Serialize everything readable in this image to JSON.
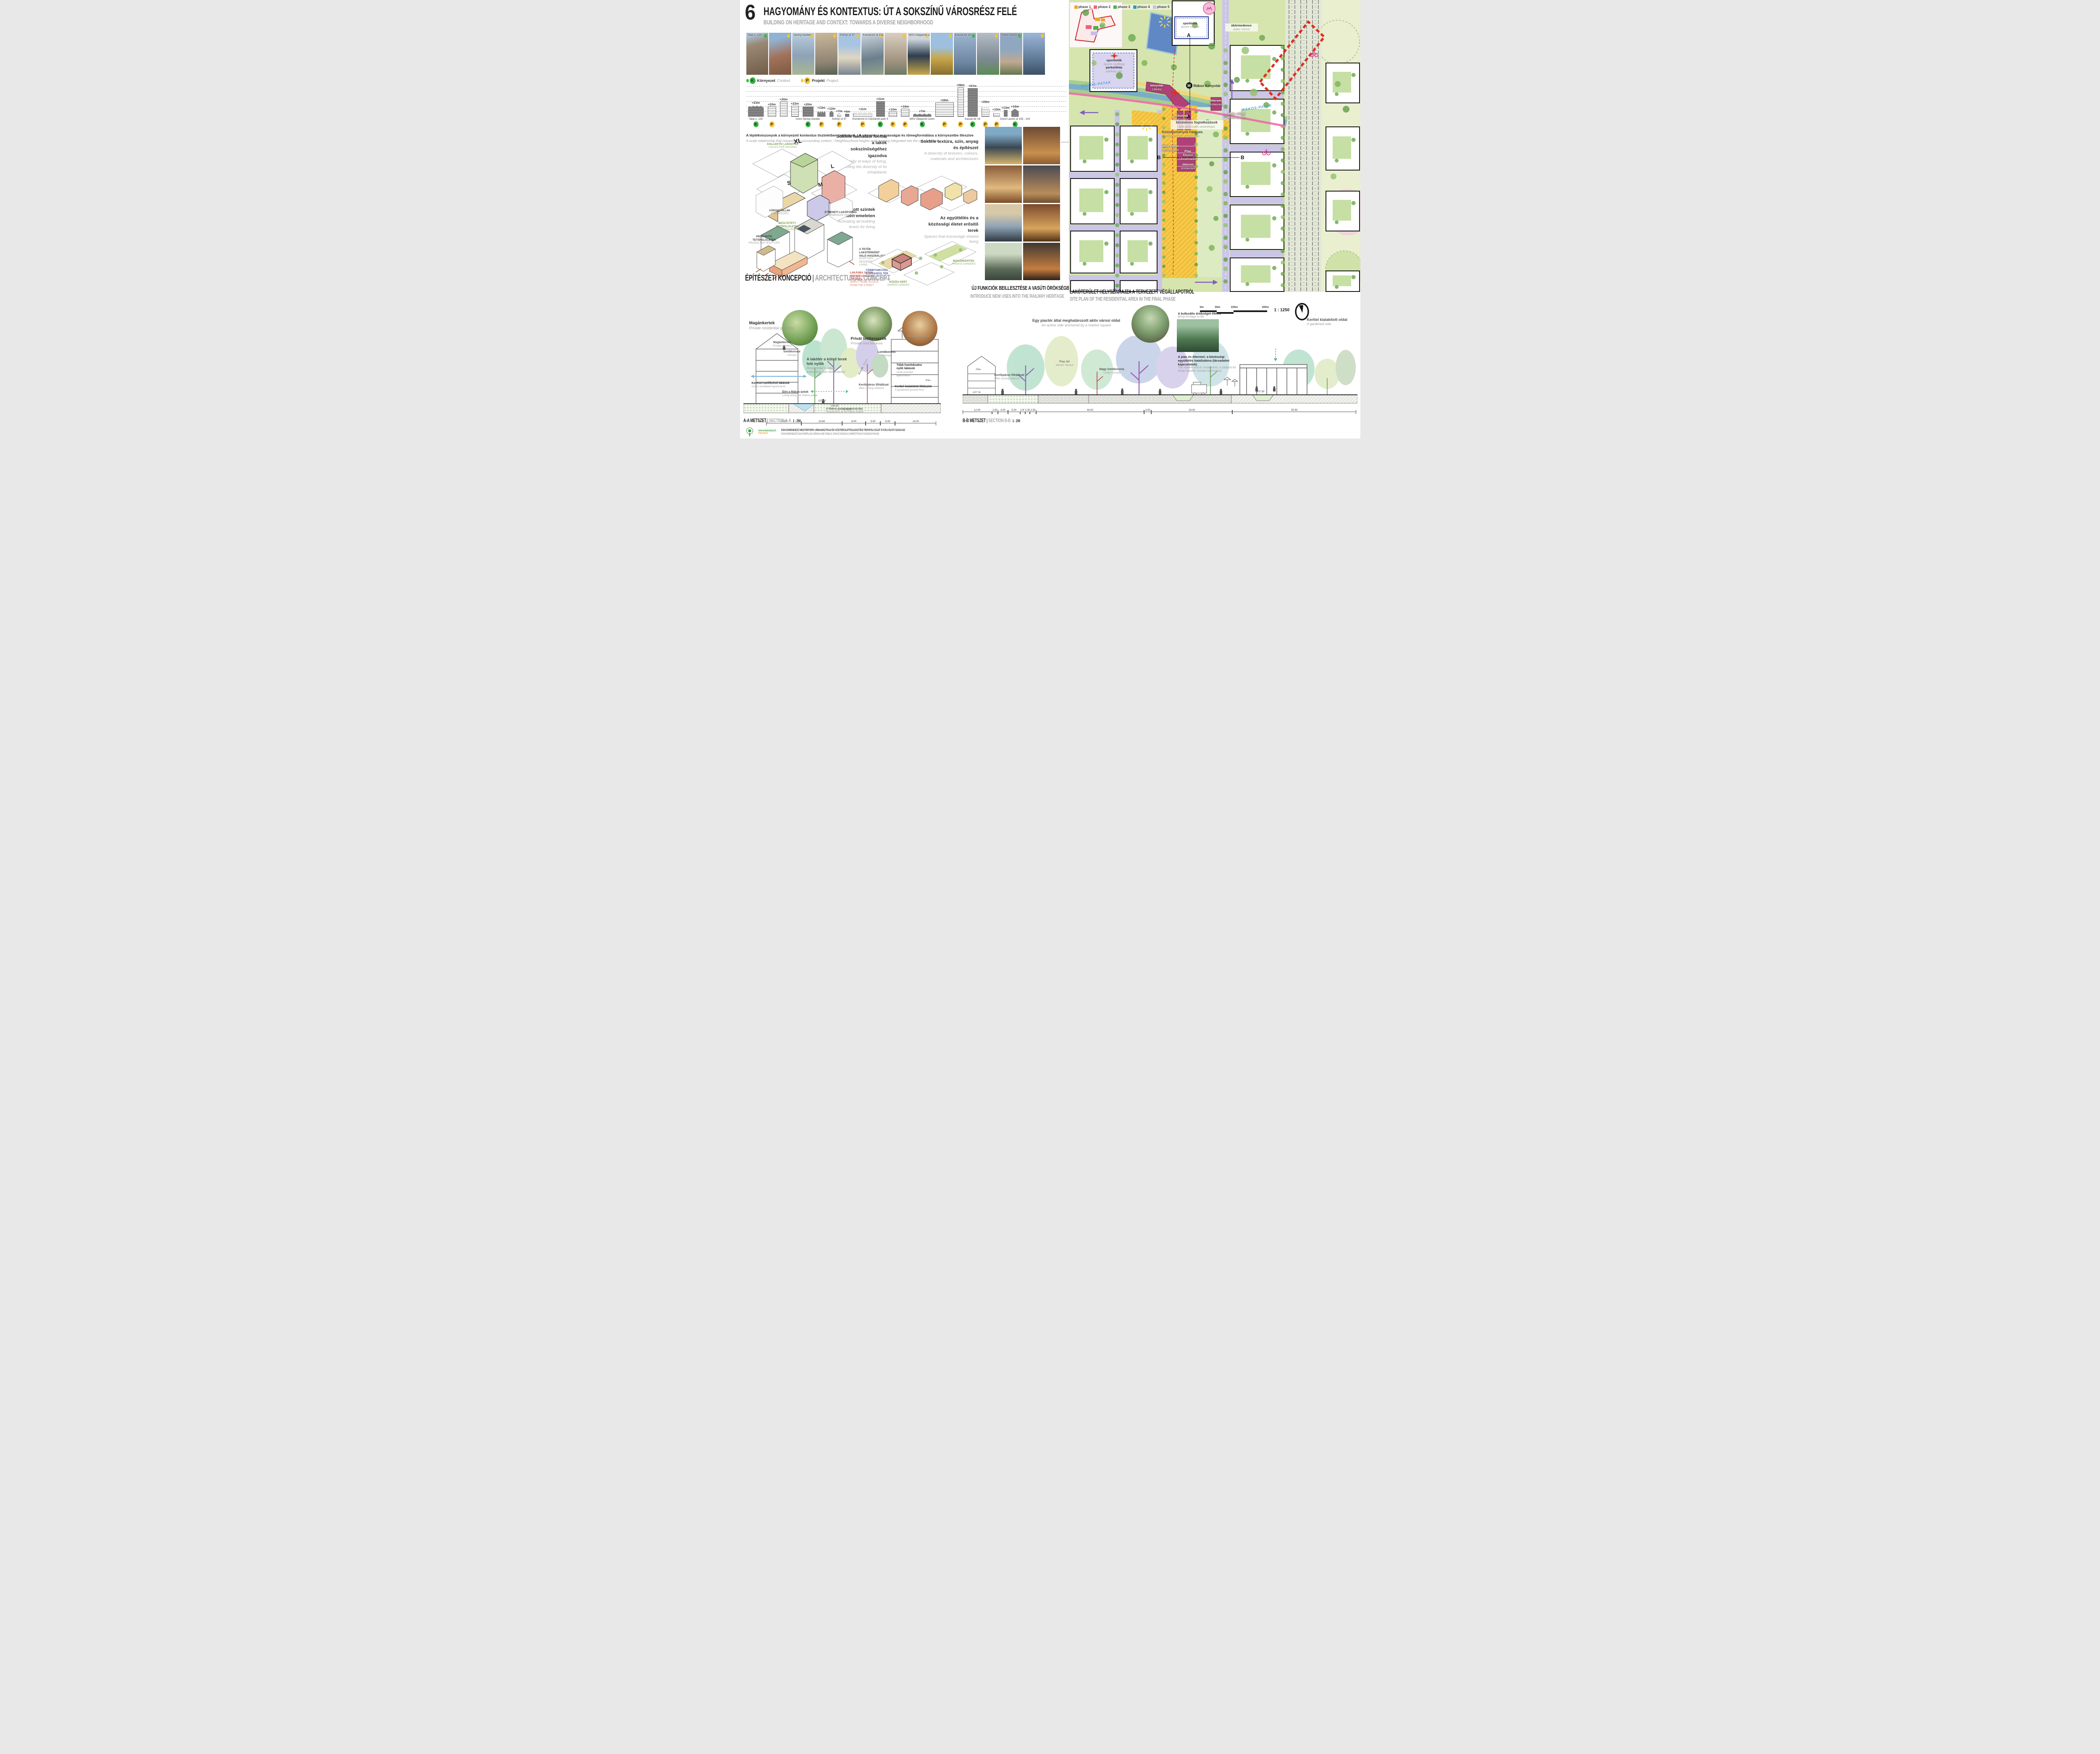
{
  "header": {
    "number": "6",
    "title": "HAGYOMÁNY ÉS KONTEXTUS: ÚT A SOKSZÍNŰ VÁROSRÉSZ FELÉ",
    "subtitle": "BUILDING ON HERITAGE AND CONTEXT: TOWARDS A DIVERSE NEIGHBORHOOD"
  },
  "legend": {
    "context_letter": "K",
    "context_hu": "Környezet",
    "context_en": "Context",
    "project_letter": "P",
    "project_hu": "Projekt",
    "project_en": "Project",
    "green": "#3db54a",
    "yellow": "#f5c23c"
  },
  "photo_strip": {
    "tiles": [
      {
        "label": "Tatai u. 124",
        "dot": "#3db54a"
      },
      {
        "label": "",
        "dot": "#f5c23c"
      },
      {
        "label": "Spring Garden",
        "dot": "#f5c23c"
      },
      {
        "label": "",
        "dot": "#f5c23c"
      },
      {
        "label": "Szőnyi út 47",
        "dot": "#f5c23c"
      },
      {
        "label": "Komáromi út 10a",
        "dot": "#f5c23c"
      },
      {
        "label": "",
        "dot": "#f5c23c"
      },
      {
        "label": "MÁV Gépjavító üzem",
        "dot": "#f5c23c"
      },
      {
        "label": "",
        "dot": "#f5c23c"
      },
      {
        "label": "Kassai tér 18",
        "dot": "#3db54a"
      },
      {
        "label": "",
        "dot": "#f5c23c"
      },
      {
        "label": "Szent László út 156",
        "dot": "#3db54a"
      },
      {
        "label": "",
        "dot": "#f5c23c"
      }
    ]
  },
  "height_diagram": {
    "caption_hu": "A léptékviszonyok a környezeti kontextus tiszteletben tartásával. / A városrész magasságai és tömegformálása a környezetbe illesztve",
    "caption_en": "A scale relationship that respects the surrounding context. / Neighbourhood heights and massing integrated into the urban context",
    "buildings": [
      {
        "h": "+23m",
        "m": 23,
        "w": 38,
        "tone": "dark",
        "shape": "dome",
        "name": "Tatai u. 124",
        "badge": "K"
      },
      {
        "h": "+20m",
        "m": 20,
        "w": 20,
        "tone": "light",
        "shape": "flat",
        "badge": "P"
      },
      {
        "h": "+30m",
        "m": 30,
        "w": 18,
        "tone": "light",
        "shape": "flat"
      },
      {
        "h": "+22m",
        "m": 22,
        "w": 18,
        "tone": "light",
        "shape": "flat"
      },
      {
        "h": "+20m",
        "m": 20,
        "w": 26,
        "tone": "dark",
        "shape": "flat",
        "name": "Avico Spring Garden",
        "badge": "K"
      },
      {
        "h": "+13m",
        "m": 13,
        "w": 20,
        "tone": "dark",
        "shape": "saw",
        "badge": "P"
      },
      {
        "h": "+12m",
        "m": 12,
        "w": 10,
        "tone": "dark",
        "shape": "gable"
      },
      {
        "h": "+7m",
        "m": 7,
        "w": 9,
        "tone": "light",
        "shape": "gable",
        "name": "Szőnyi út 47",
        "badge": "P"
      },
      {
        "h": "+6m",
        "m": 6,
        "w": 10,
        "tone": "dark",
        "shape": "flat"
      },
      {
        "h": "+11m",
        "m": 11,
        "w": 46,
        "tone": "light",
        "shape": "saw",
        "name": "Komáromi út 10a",
        "badge": "P"
      },
      {
        "h": "+31m",
        "m": 31,
        "w": 21,
        "tone": "dark",
        "shape": "flat",
        "name": "Sárrét park 4",
        "badge": "K"
      },
      {
        "h": "+10m",
        "m": 10,
        "w": 20,
        "tone": "light",
        "shape": "flat",
        "badge": "P"
      },
      {
        "h": "+16m",
        "m": 16,
        "w": 20,
        "tone": "light",
        "shape": "flat",
        "badge": "P"
      },
      {
        "h": "+7m",
        "m": 7,
        "w": 44,
        "tone": "dark",
        "shape": "saw",
        "name": "MÁV Gépjavító üzem",
        "badge": "K"
      },
      {
        "h": "+28m",
        "m": 28,
        "w": 44,
        "tone": "light",
        "shape": "flat",
        "badge": "P"
      },
      {
        "h": "+58m",
        "m": 58,
        "w": 15,
        "tone": "light",
        "shape": "flat",
        "badge": "P"
      },
      {
        "h": "+57m",
        "m": 57,
        "w": 24,
        "tone": "dark",
        "shape": "flat",
        "name": "Kassai tér 18",
        "badge": "K"
      },
      {
        "h": "+25m",
        "m": 25,
        "w": 19,
        "tone": "light",
        "shape": "saw",
        "badge": "P"
      },
      {
        "h": "+10m",
        "m": 10,
        "w": 16,
        "tone": "light",
        "shape": "saw",
        "badge": "P"
      },
      {
        "h": "+13m",
        "m": 13,
        "w": 9,
        "tone": "dark",
        "shape": "flat"
      },
      {
        "h": "+16m",
        "m": 16,
        "w": 18,
        "tone": "dark",
        "shape": "gable",
        "name": "Szent László út 156 - 143",
        "badge": "K"
      }
    ]
  },
  "concept": {
    "heading_hu": "ÉPÍTÉSZETI KONCEPCIÓ",
    "heading_en": "ARCHITECTURAL CONCEPT",
    "blocks": [
      {
        "hu": "Sokféle lakhatási forma, a lakók sokszínűségéhez igazodva",
        "en": "A diversity of ways of living, reflecting the diversity of its inhabitants"
      },
      {
        "hu": "Sokféle textúra, szín, anyag és építészet",
        "en": "A diversity of textures, colours, materials and architectures"
      },
      {
        "hu": "Lakott szintek minden emeleten",
        "en": "Activating all building levels for living"
      },
      {
        "hu": "Az együttélés és a közösségi életet erősítő terek",
        "en": "Spaces that encourage shared living"
      }
    ],
    "d1": {
      "collective_hu": "KOLLEKTÍV LAKHATÁS",
      "collective_en": "COLLECTIVE HOUSING",
      "xl": "XL",
      "l": "L",
      "s": "S",
      "m": "M",
      "villas_hu": "VÁROSI VILLÁK",
      "villas_en": "ROW HOUSES",
      "interm_hu": "ÁTMENETI LAKÓFORMA",
      "interm_en": "INTERMEDIATE HOUSING"
    },
    "d3": {
      "veg_hu": "BEÜLTETETT TETŐFELÜLETEK",
      "veg_en": "VEGETATED ROOFS",
      "prod_hu": "PRODUKTÍV TETŐFELÜLETEK",
      "prod_en": "PRODUCTIVE ROOFTOPS",
      "roofliv_hu": "A TETŐK LAKÓTÉRKÉNT VALÓ HASZNÁLATA",
      "roofliv_en": "ROOFTOPS DESIGNED FOR LIVING",
      "access_hu": "LAKÁSBA JUTÁS KÖZVETLENÜL AZ UTCÁRÓL",
      "access_en": "DIRECT HOME ACCESS FROM THE STREET"
    },
    "d4": {
      "multi_hu": "TÖBBFUNKCIÓS KÖZÖSSÉGI TÉR",
      "multi_en": "MULTIPURPOSE COMMUNITY ROOM",
      "shared_hu": "KÖZÖS KERT",
      "shared_en": "SHARED GARDEN",
      "private_hu": "MAGÁNKERTEK",
      "private_en": "PRIVATE GARDENS"
    }
  },
  "railway_heading": {
    "hu": "ÚJ FUNKCIÓK BEILLESZTÉSE A VASÚTI ÖRÖKSÉGBE",
    "en": "INTRODUCE NEW USES INTO THE RAILWAY HERITAGE"
  },
  "siteplan": {
    "heading_hu": "LAKÓTERÜLET HELYSZÍNRAJZA A TERVEZETT VÉGÁLLAPOTRÓL",
    "heading_en": "SITE PLAN OF THE RESIDENTIAL AREA IN THE FINAL PHASE",
    "phases": [
      {
        "label": "phase 1",
        "color": "#f0a32a"
      },
      {
        "label": "phase 2",
        "color": "#e8647c"
      },
      {
        "label": "phase 3",
        "color": "#4cb050"
      },
      {
        "label": "phase 4",
        "color": "#2f9bb5"
      },
      {
        "label": "phase 5",
        "color": "#c9bce6"
      }
    ],
    "scalebar": {
      "t0": "0m",
      "t50": "50m",
      "t100": "100m",
      "t200": "200m",
      "ratio": "1 : 1250"
    },
    "labels": {
      "box1_hu": "sporttetők",
      "box1_en": "Sports rooftop",
      "box2a_hu": "sporttetők",
      "box2a_en": "Sports rooftoop",
      "box2b_hu": "parkolóház",
      "box2b_en": "parking silo",
      "water_hu": "ükörmedence",
      "water_en": "water mirror",
      "river1": "RÁKOS-PATAK",
      "river2": "RÁKOS-PATAK",
      "plaza_top_hu": "aktív előtér",
      "plaza_top_en": "active plaza",
      "metro_m": "M",
      "library_point": "Rákos Könyvtár",
      "konyvtar_hu": "könyvtár",
      "konyvtar_en": "Library",
      "etterem1_hu": "étterem",
      "etterem1_en": "restaurant",
      "muhelyek_hu": "műhelyek",
      "muhelyek_en": "workshops",
      "kezmuves_hu": "kézműves foglalkozások",
      "kezmuves_en": "Arts and crafts workshops",
      "kozint_hu": "Közintézmények hálózata",
      "kozint_en": "A public facilities archipelago",
      "plaza_mid_hu": "aktív előtér",
      "plaza_mid_en": "active plaza",
      "piac_hu": "Piac",
      "piac_en1": "Market",
      "piac_en2": "/ foodmarket",
      "etterem2_hu": "étterem",
      "etterem2_en": "restaurant",
      "marker_a": "A",
      "marker_b": "B"
    }
  },
  "section_a": {
    "heading_hu": "A-A METSZET",
    "heading_en": "SECTION A-A",
    "scale": "1 : 250",
    "dims": [
      12.0,
      13.84,
      8.0,
      5.0,
      5.0,
      14.0
    ],
    "levels": [
      "107.00",
      "106.25",
      "105.50"
    ],
    "labels": {
      "magan_big_hu": "Magánkertek",
      "magan_big_en": "Private residential gardens",
      "magan_small_hu": "Magánkertek",
      "magan_small_en": "Private gardens",
      "lombkorona_hu": "lombkorona",
      "lombkorona_en": "canopy",
      "lakoter_hu": "A lakótér a külső terek felé nyílik",
      "lakoter_en": "Residential spaces extending into the exterior",
      "kereszt_hu": "Kereszt-szellőzésű lakások",
      "kereszt_en": "Cross-ventilated apartments",
      "elet_hu": "Élet a Rákos-patak",
      "elet_en": "Living along the Rákos-patak",
      "renat_hu": "A Rákos-patak renaturációja",
      "renat_en": "Renaturation of the Rákos stream",
      "privat_hu": "Privát tetőteraszok",
      "privat_en": "Private roof terraces",
      "inhabit_en": "Inhabiting the roof",
      "lombkorona2_hu": "Lombkorona",
      "lombkorona2_en": "Canopy",
      "tobb_hu": "Több homlokzatra nyíló lakások",
      "tobb_en": "multi-oriented apartments",
      "kerekparos_hu": "Kerékpáros főhálózat",
      "kerekparos_en": "Main cycling network",
      "kerttel_hu": "Kerttel kialakított földszint",
      "kerttel_en": "A gardened ground floor",
      "arnyek_hu": "Árnyék",
      "arnyek_en": "Shade",
      "co2": "Co₂"
    }
  },
  "section_b": {
    "heading_hu": "B-B METSZET",
    "heading_en": "SECTION B-B",
    "scale": "1 : 250",
    "dims": [
      12.0,
      2.5,
      4.0,
      5.0,
      2.0,
      2.0,
      2.5,
      44.0,
      3.0,
      33.0,
      50.5
    ],
    "levels": [
      "107.74",
      "107.59"
    ],
    "labels": {
      "piacter_top_hu": "Egy piactér által meghatározott aktív városi oldal",
      "piacter_top_en": "An active side anchored by a market square",
      "kult_hu": "A kulturális örökséget éltetni",
      "kult_en": "Bring heritage to life",
      "piacter_hu": "Piac tér",
      "piacter_en": "Market Square",
      "lombkorona_hu": "Nagy lombkorona",
      "lombkorona_en": "Large canopy",
      "kerekparos_hu": "Kerékpáros főhálózat",
      "kerekparos_en": "Main cycling network",
      "piac_etterem_hu": "A piac és éttermei: a közösségi együttélés katalizátora (társadalmi kapcsolatok)",
      "piac_etterem_en": "The market and its restaurants: a catalyst for living together (social connection)",
      "kerttel_hu": "Kerttel kialakított oldal",
      "kerttel_en": "A gardened side",
      "arnyek_hu": "Árnyék",
      "arnyek_en": "Shade",
      "co2": "Co₂"
    }
  },
  "footer": {
    "logo_l1": "RÁKOSRENDEZŐ",
    "logo_l2": "PROJEKT",
    "line1": "RÁKOSRENDEZŐ MESTERTERV URBANISZTIKAI ÉS KÖZTERÜLETFEJLESZTÉSI TERVPÁLYÁZAT /// PÁLYÁZATI SZAKASZ",
    "line2": "RÁKOSRENDEZŐ MASTERPLAN URBAN AND PUBLIC SPACE DESIGN COMPETITION /// DESIGN PHASE"
  }
}
